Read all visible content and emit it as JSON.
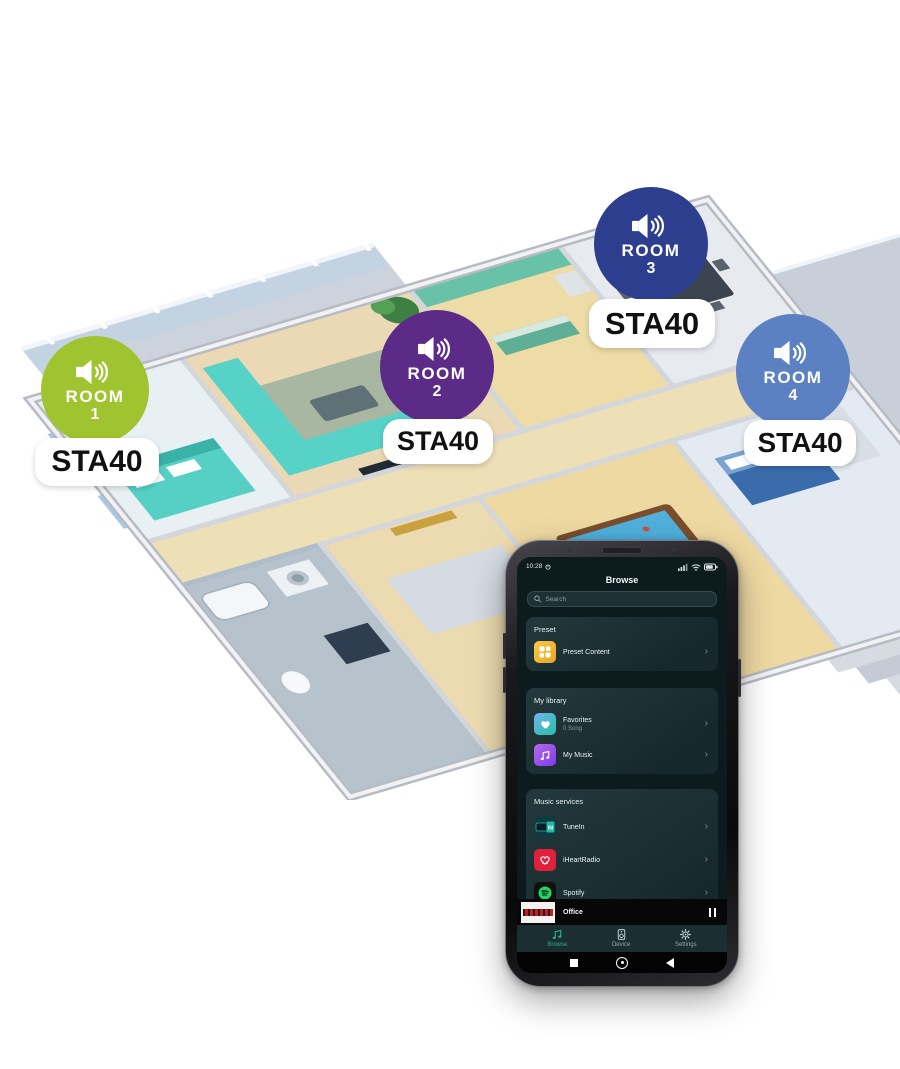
{
  "rooms": [
    {
      "label": "ROOM",
      "number": "1",
      "device": "STA40",
      "color": "#9fc42f"
    },
    {
      "label": "ROOM",
      "number": "2",
      "device": "STA40",
      "color": "#5b2b87"
    },
    {
      "label": "ROOM",
      "number": "3",
      "device": "STA40",
      "color": "#2d3e8f"
    },
    {
      "label": "ROOM",
      "number": "4",
      "device": "STA40",
      "color": "#5b81c2"
    }
  ],
  "phone": {
    "chevron": "›",
    "status_bar": {
      "time": "10:28"
    },
    "header": {
      "title": "Browse"
    },
    "search": {
      "placeholder": "Search"
    },
    "sections": {
      "preset": {
        "label": "Preset",
        "items": [
          {
            "label": "Preset Content",
            "icon": "preset-grid-icon"
          }
        ]
      },
      "library": {
        "label": "My library",
        "items": [
          {
            "label": "Favorites",
            "sublabel": "0 Song",
            "icon": "heart-icon"
          },
          {
            "label": "My Music",
            "icon": "music-note-icon"
          }
        ]
      },
      "services": {
        "label": "Music services",
        "items": [
          {
            "label": "TuneIn",
            "icon": "tunein-logo",
            "logo_text": "IN"
          },
          {
            "label": "iHeartRadio",
            "icon": "iheartradio-logo"
          },
          {
            "label": "Spotify",
            "icon": "spotify-logo"
          }
        ]
      }
    },
    "now_playing": {
      "title": "Office"
    },
    "nav": {
      "items": [
        {
          "label": "Browse",
          "active": true,
          "icon": "music-notes-icon"
        },
        {
          "label": "Device",
          "active": false,
          "icon": "speaker-device-icon"
        },
        {
          "label": "Settings",
          "active": false,
          "icon": "gear-icon"
        }
      ]
    }
  },
  "colors": {
    "phone_screen_bg": "#0c1b1e",
    "card_bg": "#1f3338",
    "accent_green": "#2fae85",
    "preset_yellow": "#f0b62f",
    "iheart_red": "#e1203c",
    "spotify_green": "#1ed760",
    "tunein_teal": "#25b6aa",
    "pill_bg": "#ffffff",
    "pill_text": "#111111"
  }
}
